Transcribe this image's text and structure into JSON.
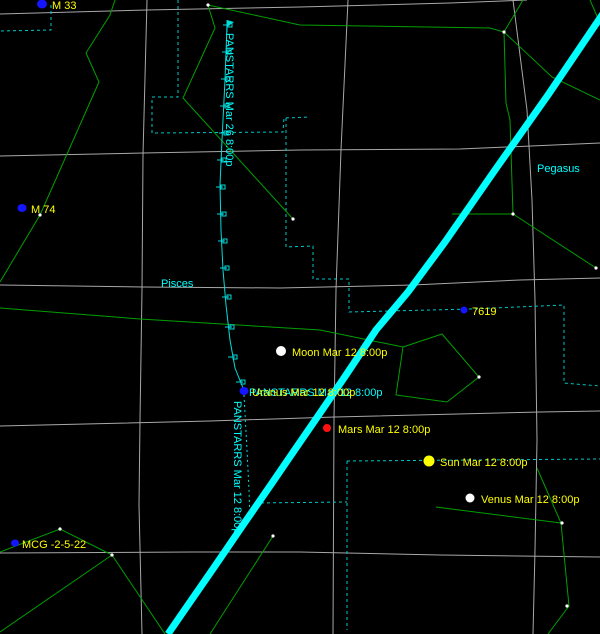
{
  "canvas": {
    "width": 600,
    "height": 634,
    "background": "#000000"
  },
  "styles": {
    "grid_color": "#a8a8a8",
    "boundary_color": "#00c8c8",
    "constellation_color": "#00a000",
    "track_color": "#00dddd",
    "horizon_color": "#00ffff",
    "horizon_width": 7,
    "label_yellow": "#ffff00",
    "label_cyan": "#00ffff",
    "star_color": "#ffffff",
    "galaxy_blue": "#1515ff",
    "font_size": 11
  },
  "gridlines": [
    {
      "points": [
        [
          0,
          14
        ],
        [
          147,
          10
        ],
        [
          300,
          7
        ],
        [
          450,
          3
        ],
        [
          527,
          0
        ]
      ]
    },
    {
      "points": [
        [
          0,
          156
        ],
        [
          143,
          153
        ],
        [
          300,
          150
        ],
        [
          460,
          149
        ],
        [
          600,
          143
        ]
      ]
    },
    {
      "points": [
        [
          0,
          285
        ],
        [
          143,
          287
        ],
        [
          280,
          288
        ],
        [
          413,
          285
        ],
        [
          520,
          280
        ],
        [
          600,
          278
        ]
      ]
    },
    {
      "points": [
        [
          0,
          426
        ],
        [
          210,
          421
        ],
        [
          335,
          417
        ],
        [
          540,
          412
        ],
        [
          600,
          411
        ]
      ]
    },
    {
      "points": [
        [
          0,
          553
        ],
        [
          193,
          552
        ],
        [
          300,
          552
        ],
        [
          440,
          555
        ],
        [
          600,
          557
        ]
      ]
    },
    {
      "points": [
        [
          147,
          0
        ],
        [
          143,
          155
        ],
        [
          142,
          290
        ],
        [
          140,
          420
        ],
        [
          139,
          505
        ],
        [
          142,
          634
        ]
      ]
    },
    {
      "points": [
        [
          348,
          0
        ],
        [
          341,
          150
        ],
        [
          336,
          290
        ],
        [
          334,
          420
        ],
        [
          333,
          634
        ]
      ]
    },
    {
      "points": [
        [
          513,
          0
        ],
        [
          527,
          110
        ],
        [
          532,
          200
        ],
        [
          535,
          300
        ],
        [
          537,
          440
        ],
        [
          535,
          550
        ],
        [
          533,
          634
        ]
      ]
    }
  ],
  "boundaries": [
    {
      "points": [
        [
          51,
          5
        ],
        [
          51,
          30
        ],
        [
          0,
          31
        ]
      ]
    },
    {
      "points": [
        [
          178,
          0
        ],
        [
          178,
          97
        ],
        [
          152,
          97
        ],
        [
          152,
          133
        ],
        [
          283,
          132
        ],
        [
          284,
          118
        ],
        [
          310,
          117
        ]
      ]
    },
    {
      "points": [
        [
          286,
          118
        ],
        [
          286,
          247
        ],
        [
          313,
          246
        ],
        [
          313,
          279
        ],
        [
          349,
          279
        ],
        [
          349,
          312
        ],
        [
          470,
          309
        ],
        [
          564,
          305
        ],
        [
          564,
          383
        ],
        [
          600,
          386
        ]
      ]
    },
    {
      "points": [
        [
          255,
          503
        ],
        [
          347,
          502
        ]
      ]
    },
    {
      "points": [
        [
          347,
          461
        ],
        [
          600,
          459
        ]
      ]
    },
    {
      "points": [
        [
          347,
          461
        ],
        [
          347,
          630
        ]
      ]
    }
  ],
  "constellation_lines": [
    {
      "points": [
        [
          115,
          0
        ],
        [
          110,
          15
        ],
        [
          86,
          53
        ],
        [
          99,
          82
        ],
        [
          40,
          215
        ],
        [
          0,
          282
        ]
      ]
    },
    {
      "points": [
        [
          208,
          5
        ],
        [
          215,
          28
        ],
        [
          183,
          98
        ],
        [
          293,
          219
        ]
      ]
    },
    {
      "points": [
        [
          208,
          5
        ],
        [
          300,
          25
        ],
        [
          490,
          28
        ],
        [
          504,
          32
        ]
      ]
    },
    {
      "points": [
        [
          504,
          32
        ],
        [
          523,
          0
        ]
      ]
    },
    {
      "points": [
        [
          590,
          0
        ],
        [
          600,
          23
        ]
      ]
    },
    {
      "points": [
        [
          504,
          32
        ],
        [
          552,
          77
        ],
        [
          600,
          100
        ]
      ]
    },
    {
      "points": [
        [
          504,
          32
        ],
        [
          506,
          103
        ],
        [
          510,
          120
        ],
        [
          513,
          214
        ]
      ]
    },
    {
      "points": [
        [
          452,
          214
        ],
        [
          513,
          214
        ]
      ]
    },
    {
      "points": [
        [
          513,
          214
        ],
        [
          596,
          268
        ]
      ]
    },
    {
      "points": [
        [
          0,
          308
        ],
        [
          140,
          319
        ],
        [
          320,
          330
        ],
        [
          403,
          347
        ]
      ]
    },
    {
      "points": [
        [
          442,
          334
        ],
        [
          403,
          347
        ],
        [
          396,
          395
        ],
        [
          447,
          402
        ],
        [
          479,
          377
        ]
      ],
      "closed": true
    },
    {
      "points": [
        [
          0,
          552
        ],
        [
          60,
          529
        ],
        [
          112,
          555
        ]
      ]
    },
    {
      "points": [
        [
          112,
          555
        ],
        [
          0,
          632
        ]
      ]
    },
    {
      "points": [
        [
          112,
          555
        ],
        [
          165,
          634
        ]
      ]
    },
    {
      "points": [
        [
          210,
          634
        ],
        [
          273,
          536
        ]
      ]
    },
    {
      "points": [
        [
          436,
          507
        ],
        [
          561,
          523
        ]
      ]
    },
    {
      "points": [
        [
          537,
          468
        ],
        [
          561,
          523
        ]
      ]
    },
    {
      "points": [
        [
          561,
          523
        ],
        [
          569,
          606
        ],
        [
          548,
          634
        ]
      ]
    }
  ],
  "horizon": {
    "points": [
      [
        615,
        -4
      ],
      [
        548,
        95
      ],
      [
        495,
        170
      ],
      [
        445,
        242
      ],
      [
        408,
        292
      ],
      [
        376,
        330
      ],
      [
        344,
        378
      ],
      [
        318,
        416
      ],
      [
        296,
        448
      ],
      [
        270,
        486
      ],
      [
        243,
        525
      ],
      [
        215,
        566
      ],
      [
        188,
        605
      ],
      [
        168,
        634
      ]
    ]
  },
  "comet_track": {
    "solid_points": [
      [
        227,
        25
      ],
      [
        225,
        80
      ],
      [
        222,
        140
      ],
      [
        220,
        185
      ],
      [
        221,
        230
      ],
      [
        223,
        270
      ],
      [
        226,
        305
      ],
      [
        230,
        340
      ],
      [
        235,
        368
      ],
      [
        243,
        388
      ]
    ],
    "dashed_points": [
      [
        244,
        395
      ],
      [
        247,
        450
      ],
      [
        249,
        490
      ],
      [
        250,
        520
      ]
    ],
    "ticks": [
      [
        227,
        25
      ],
      [
        226,
        52
      ],
      [
        225,
        79
      ],
      [
        224,
        106
      ],
      [
        223,
        133
      ],
      [
        221,
        160
      ],
      [
        220,
        187
      ],
      [
        221,
        214
      ],
      [
        222,
        241
      ],
      [
        224,
        268
      ],
      [
        226,
        297
      ],
      [
        229,
        327
      ],
      [
        232,
        357
      ],
      [
        240,
        382
      ]
    ],
    "flag": {
      "pole": [
        [
          227,
          32
        ],
        [
          227,
          20
        ]
      ],
      "pennant": [
        [
          227,
          20
        ],
        [
          234,
          22
        ],
        [
          227,
          27
        ]
      ]
    }
  },
  "stars": [
    [
      208,
      5
    ],
    [
      504,
      32
    ],
    [
      513,
      214
    ],
    [
      293,
      219
    ],
    [
      40,
      215
    ],
    [
      479,
      377
    ],
    [
      596,
      268
    ],
    [
      562,
      523
    ],
    [
      567,
      606
    ],
    [
      60,
      529
    ],
    [
      112,
      555
    ],
    [
      273,
      536
    ]
  ],
  "objects": [
    {
      "name": "galaxy-m33",
      "x": 42,
      "y": 4,
      "rx": 5,
      "ry": 4.5,
      "color": "#1515ff",
      "labels": [
        {
          "text": "M 33",
          "x": 52,
          "y": 9,
          "color": "#ffff00"
        }
      ]
    },
    {
      "name": "galaxy-m74",
      "x": 22,
      "y": 208,
      "rx": 4.5,
      "ry": 4,
      "color": "#1515ff",
      "labels": [
        {
          "text": "M 74",
          "x": 31,
          "y": 213,
          "color": "#ffff00"
        }
      ]
    },
    {
      "name": "galaxy-mcg-2-5-22",
      "x": 15,
      "y": 543,
      "rx": 4,
      "ry": 3.5,
      "color": "#1515ff",
      "labels": [
        {
          "text": "MCG -2-5-22",
          "x": 22,
          "y": 548,
          "color": "#ffff00"
        }
      ]
    },
    {
      "name": "galaxy-7619",
      "x": 464,
      "y": 310,
      "rx": 3.5,
      "ry": 3.5,
      "color": "#1515ff",
      "labels": [
        {
          "text": "7619",
          "x": 472,
          "y": 315,
          "color": "#ffff00"
        }
      ]
    },
    {
      "name": "moon-marker",
      "x": 281,
      "y": 351,
      "rx": 5,
      "ry": 5,
      "color": "#ffffff",
      "labels": [
        {
          "text": "Moon Mar 12 8:00p",
          "x": 292,
          "y": 356,
          "color": "#ffff00"
        }
      ]
    },
    {
      "name": "comet-uranus-marker",
      "x": 244,
      "y": 391,
      "rx": 4.5,
      "ry": 4,
      "color": "#1515ff",
      "labels": [
        {
          "text": "PANSTARRS Mar 12 8:00p",
          "x": 249,
          "y": 396,
          "color": "#00ffff"
        },
        {
          "text": "Uranus Mar 12 8:00p",
          "x": 252,
          "y": 396,
          "color": "#ffff00"
        }
      ]
    },
    {
      "name": "mars-marker",
      "x": 327,
      "y": 428,
      "rx": 4,
      "ry": 4,
      "color": "#ff1111",
      "labels": [
        {
          "text": "Mars Mar 12 8:00p",
          "x": 338,
          "y": 433,
          "color": "#ffff00"
        }
      ]
    },
    {
      "name": "sun-marker",
      "x": 429,
      "y": 461,
      "rx": 5.5,
      "ry": 5.5,
      "color": "#ffff00",
      "labels": [
        {
          "text": "Sun Mar 12 8:00p",
          "x": 440,
          "y": 466,
          "color": "#ffff00"
        }
      ]
    },
    {
      "name": "venus-marker",
      "x": 470,
      "y": 498,
      "rx": 4.5,
      "ry": 4.5,
      "color": "#ffffff",
      "labels": [
        {
          "text": "Venus Mar 12 8:00p",
          "x": 481,
          "y": 503,
          "color": "#ffff00"
        }
      ]
    }
  ],
  "constellation_labels": [
    {
      "name": "pisces-label",
      "text": "Pisces",
      "x": 161,
      "y": 287
    },
    {
      "name": "pegasus-label",
      "text": "Pegasus",
      "x": 537,
      "y": 172
    }
  ],
  "track_labels": [
    {
      "name": "panstarrs-mar26-label",
      "text": "PANSTARRS Mar 26 8:00p",
      "x": 226,
      "y": 33,
      "rotate": 90
    },
    {
      "name": "panstarrs-mar12-label",
      "text": "PANSTARRS Mar 12 8:00p",
      "x": 234,
      "y": 401,
      "rotate": 90
    }
  ]
}
